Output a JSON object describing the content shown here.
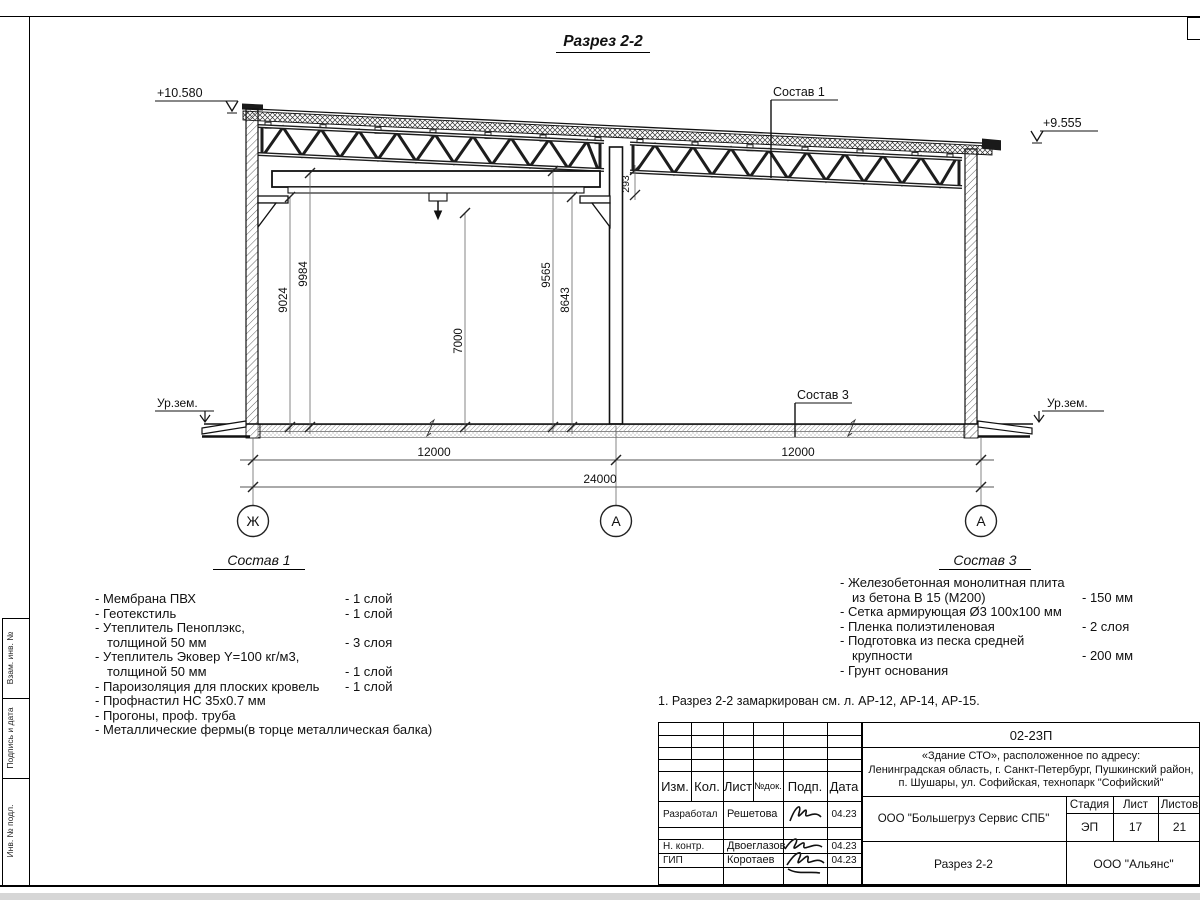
{
  "sheet": {
    "title": "Разрез 2-2",
    "note": "1. Разрез 2-2 замаркирован см. л. АР-12, АР-14, АР-15.",
    "frame_stamps": [
      "Взам. инв. №",
      "Подпись и дата",
      "Инв. № подл."
    ]
  },
  "drawing": {
    "elevations": {
      "left": "+10.580",
      "right": "+9.555"
    },
    "ground_labels": {
      "left": "Ур.зем.",
      "right": "Ур.зем."
    },
    "callouts": {
      "roof": "Состав 1",
      "floor": "Состав 3"
    },
    "vertical_dims": {
      "v9024": "9024",
      "v9984": "9984",
      "v7000": "7000",
      "v9565": "9565",
      "v8643": "8643",
      "v293": "293"
    },
    "horizontal_dims": {
      "span_left": "12000",
      "span_right": "12000",
      "total": "24000"
    },
    "axes": {
      "left": "Ж",
      "middle": "А",
      "right": "А"
    }
  },
  "sostav1": {
    "heading": "Состав 1",
    "items": [
      {
        "text": "- Мембрана ПВХ",
        "value": "- 1 слой"
      },
      {
        "text": "- Геотекстиль",
        "value": "- 1 слой"
      },
      {
        "text": "- Утеплитель Пеноплэкс,",
        "value": ""
      },
      {
        "text": "толщиной 50 мм",
        "value": "- 3 слоя"
      },
      {
        "text": "- Утеплитель Эковер Y=100 кг/м3,",
        "value": ""
      },
      {
        "text": "толщиной 50 мм",
        "value": "- 1 слой"
      },
      {
        "text": "- Пароизоляция для плоских кровель",
        "value": "- 1 слой"
      },
      {
        "text": "- Профнастил НС 35х0.7 мм",
        "value": ""
      },
      {
        "text": "- Прогоны, проф. труба",
        "value": ""
      },
      {
        "text": "- Металлические фермы(в торце металлическая балка)",
        "value": ""
      }
    ]
  },
  "sostav3": {
    "heading": "Состав 3",
    "items": [
      {
        "text": "- Железобетонная монолитная плита",
        "value": ""
      },
      {
        "text": "из бетона В 15 (М200)",
        "value": "- 150 мм"
      },
      {
        "text": "- Сетка армирующая Ø3 100х100 мм",
        "value": ""
      },
      {
        "text": "- Пленка полиэтиленовая",
        "value": "- 2 слоя"
      },
      {
        "text": "- Подготовка из песка средней",
        "value": ""
      },
      {
        "text": "крупности",
        "value": "- 200 мм"
      },
      {
        "text": "- Грунт основания",
        "value": ""
      }
    ]
  },
  "titleblock": {
    "doc_number": "02-23П",
    "object_line1": "«Здание СТО», расположенное по адресу:",
    "object_line2": "Ленинградская область, г. Санкт-Петербург, Пушкинский район,",
    "object_line3": "п. Шушары, ул. Софийская, технопарк \"Софийский\"",
    "cols": {
      "izm": "Изм.",
      "kol": "Кол.",
      "list": "Лист",
      "ndok": "№док.",
      "podp": "Подп.",
      "date": "Дата"
    },
    "rows": [
      {
        "role": "Разработал",
        "name": "Решетова",
        "date": "04.23"
      },
      {
        "role": "Н. контр.",
        "name": "Двоеглазов",
        "date": "04.23"
      },
      {
        "role": "ГИП",
        "name": "Коротаев",
        "date": "04.23"
      }
    ],
    "stage_label": "Стадия",
    "sheet_label": "Лист",
    "sheets_label": "Листов",
    "stage": "ЭП",
    "sheet": "17",
    "sheets": "21",
    "org": "ООО \"Большегруз Сервис СПБ\"",
    "drawing_name": "Разрез 2-2",
    "company": "ООО \"Альянс\""
  }
}
